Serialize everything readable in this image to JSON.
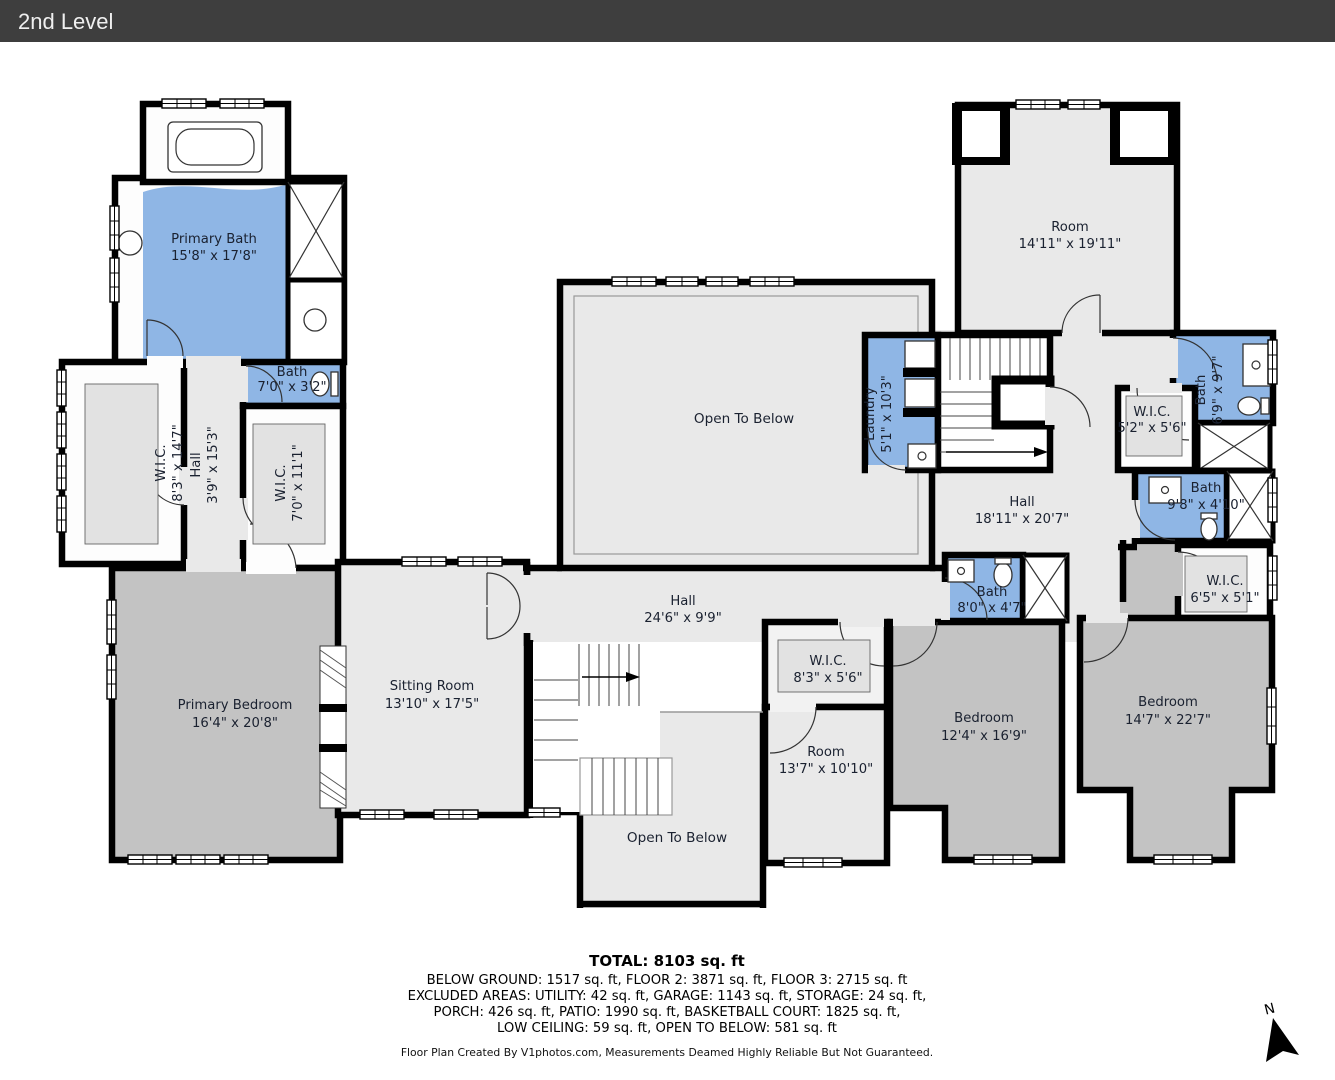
{
  "header": {
    "title": "2nd Level",
    "bg": "#3e3e3e"
  },
  "colors": {
    "wall": "#000000",
    "wet_room": "#8fb6e5",
    "room_light": "#e9e9e9",
    "room_dark": "#c3c3c3",
    "label_text": "#1a2130",
    "header_bg": "#3e3e3e"
  },
  "rooms": {
    "primary_bath": {
      "name": "Primary Bath",
      "dims": "15'8\" x 17'8\""
    },
    "bath_small": {
      "name": "Bath",
      "dims": "7'0\" x 3'2\""
    },
    "wic_left": {
      "name": "W.I.C.",
      "dims": "8'3\" x 14'7\""
    },
    "hall_left": {
      "name": "Hall",
      "dims": "3'9\" x 15'3\""
    },
    "wic_left2": {
      "name": "W.I.C.",
      "dims": "7'0\" x 11'1\""
    },
    "open_below_top": {
      "name": "Open To Below"
    },
    "laundry": {
      "name": "Laundry",
      "dims": "5'1\" x 10'3\""
    },
    "room_top": {
      "name": "Room",
      "dims": "14'11\" x 19'11\""
    },
    "hall_main": {
      "name": "Hall",
      "dims": "18'11\" x 20'7\""
    },
    "wic_52": {
      "name": "W.I.C.",
      "dims": "5'2\" x 5'6\""
    },
    "bath_69": {
      "name": "Bath",
      "dims": "6'9\" x 9'7\""
    },
    "bath_98": {
      "name": "Bath",
      "dims": "9'8\" x 4'10\""
    },
    "wic_65": {
      "name": "W.I.C.",
      "dims": "6'5\" x 5'1\""
    },
    "bath_80": {
      "name": "Bath",
      "dims": "8'0\" x 4'7\""
    },
    "wic_83": {
      "name": "W.I.C.",
      "dims": "8'3\" x 5'6\""
    },
    "bedroom_mid": {
      "name": "Bedroom",
      "dims": "12'4\" x 16'9\""
    },
    "bedroom_right": {
      "name": "Bedroom",
      "dims": "14'7\" x 22'7\""
    },
    "room_bottom": {
      "name": "Room",
      "dims": "13'7\" x 10'10\""
    },
    "primary_bedroom": {
      "name": "Primary Bedroom",
      "dims": "16'4\" x 20'8\""
    },
    "sitting_room": {
      "name": "Sitting Room",
      "dims": "13'10\" x 17'5\""
    },
    "hall_bottom": {
      "name": "Hall",
      "dims": "24'6\" x 9'9\""
    },
    "open_below_bottom": {
      "name": "Open To Below"
    }
  },
  "summary": {
    "total": "TOTAL: 8103 sq. ft",
    "line1": "BELOW GROUND: 1517 sq. ft, FLOOR 2: 3871 sq. ft, FLOOR 3: 2715 sq. ft",
    "line2": "EXCLUDED AREAS: UTILITY: 42 sq. ft, GARAGE: 1143 sq. ft, STORAGE: 24 sq. ft,",
    "line3": "PORCH: 426 sq. ft, PATIO: 1990 sq. ft, BASKETBALL COURT: 1825 sq. ft,",
    "line4": "LOW CEILING: 59 sq. ft, OPEN TO BELOW: 581 sq. ft",
    "credit": "Floor Plan Created By V1photos.com, Measurements Deamed Highly Reliable But Not Guaranteed."
  },
  "compass": {
    "label": "N"
  }
}
